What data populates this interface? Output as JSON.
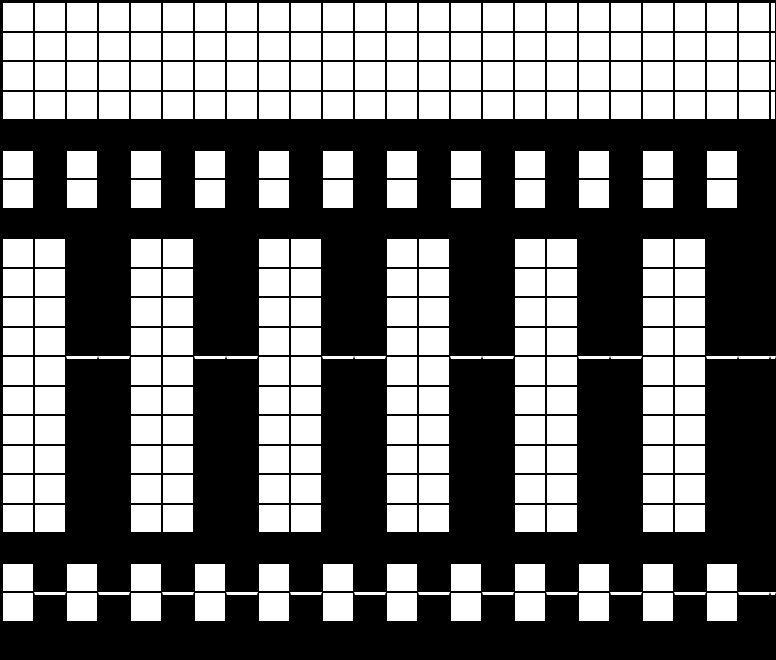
{
  "pattern": {
    "columns": 25,
    "rows_count": 22,
    "cell_encoding": {
      "1": "white-cell",
      "0": "black-cell"
    },
    "rows": [
      "1111111111111111111111111",
      "1111111111111111111111111",
      "1111111111111111111111111",
      "1111111111111111111111111",
      "0000000000000000000000000",
      "1010101010101010101010100",
      "1010101010101010101010100",
      "0000000000000000000000000",
      "1100110011001100110011000",
      "1100110011001100110011000",
      "1100110011001100110011000",
      "1100110011001100110011000",
      "1100110011001100110011000",
      "1100110011001100110011000",
      "1100110011001100110011000",
      "1100110011001100110011000",
      "1100110011001100110011000",
      "1100110011001100110011000",
      "0000000000000000000000000",
      "1010101010101010101010100",
      "1010101010101010101010100",
      "0000000000000000000000000"
    ],
    "marker_rows": [
      12,
      20
    ]
  },
  "colors": {
    "cell_white": "#ffffff",
    "cell_black": "#000000",
    "grid_line": "#000000",
    "marker_line": "#ffffff",
    "background": "#000000"
  }
}
